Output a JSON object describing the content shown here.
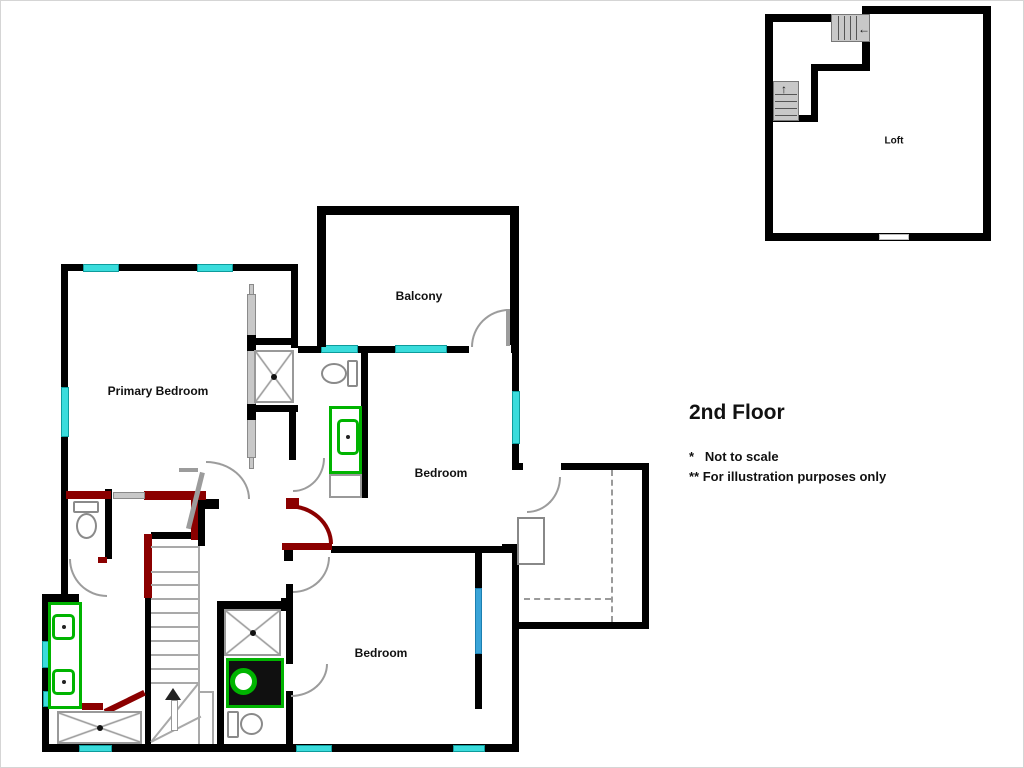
{
  "title": {
    "text": "2nd Floor"
  },
  "notes": {
    "line1": "*   Not to scale",
    "line2": "** For illustration purposes only"
  },
  "rooms": {
    "primary_bedroom": "Primary Bedroom",
    "balcony": "Balcony",
    "middle_bedroom": "Bedroom",
    "lower_bedroom": "Bedroom",
    "loft": "Loft"
  },
  "stairs": {
    "loft_entry_arrow": "←",
    "loft_up_arrow": "↑"
  },
  "colors": {
    "wall": "#000000",
    "window_cyan": "#3ADCDC",
    "window_blue": "#3AA4D8",
    "door_gray": "#9C9C9C",
    "door_red": "#8B0000",
    "fixture_green": "#00B400",
    "stair_gray": "#C8C8C8"
  }
}
